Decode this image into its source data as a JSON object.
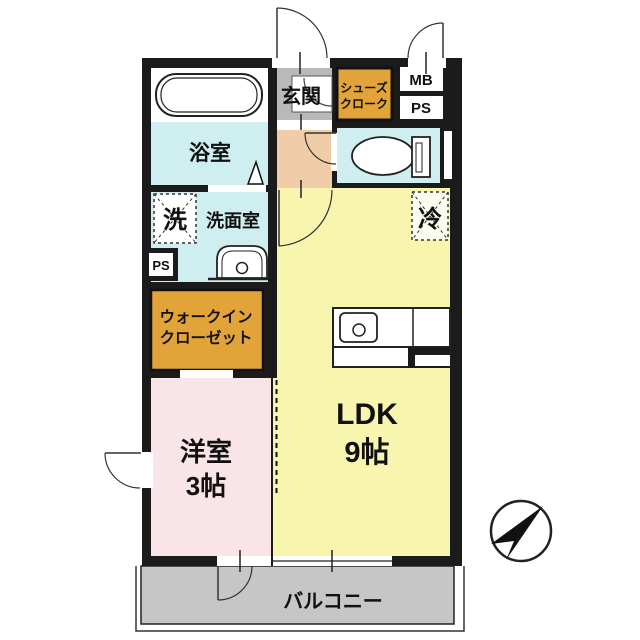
{
  "plan": {
    "rooms": {
      "genkan": "玄関",
      "shoes_closet_1": "シューズ",
      "shoes_closet_2": "クローク",
      "mb": "MB",
      "ps_top": "PS",
      "ps_side": "PS",
      "bathroom": "浴室",
      "washer": "洗",
      "washroom": "洗面室",
      "fridge": "冷",
      "wic_1": "ウォークイン",
      "wic_2": "クローゼット",
      "ldk_name": "LDK",
      "ldk_size": "9帖",
      "bedroom_name": "洋室",
      "bedroom_size": "3帖",
      "balcony": "バルコニー"
    },
    "colors": {
      "wall": "#1b1b1b",
      "water_rooms": "#cfeef0",
      "genkan_gray": "#b9b9b9",
      "hallway": "#f0cda8",
      "storage_orange": "#e2a438",
      "ldk_yellow": "#f8f5af",
      "bedroom_pink": "#f9e5e7",
      "balcony_gray": "#c6c6c6",
      "white": "#ffffff",
      "fridge_fill": "#fdfcf0"
    },
    "compass": "north-east-arrow"
  }
}
